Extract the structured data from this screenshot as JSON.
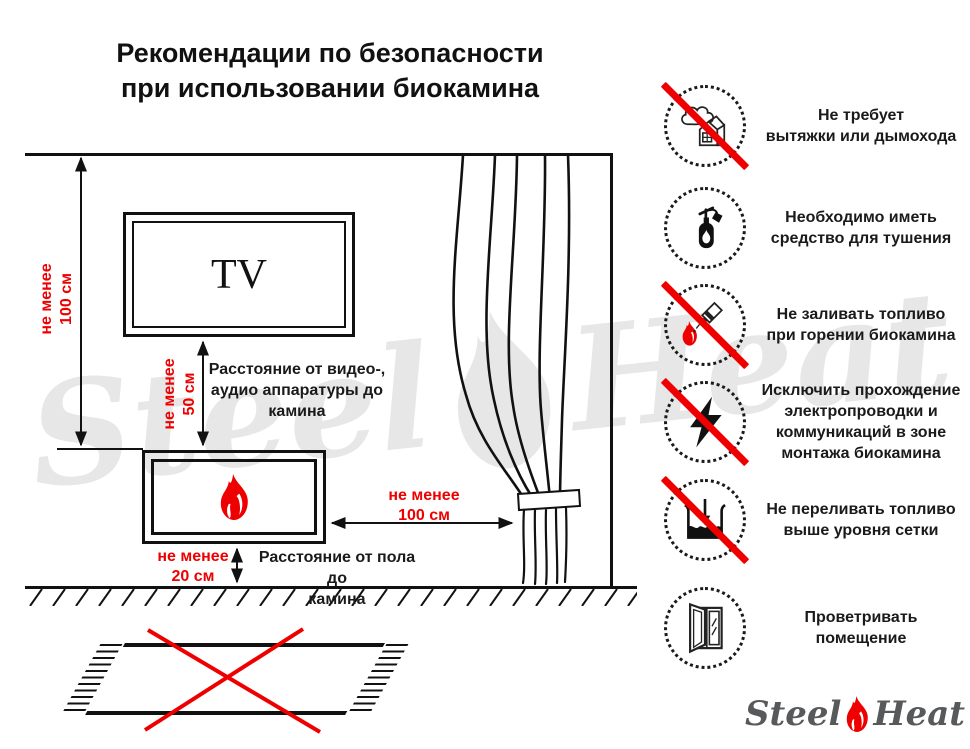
{
  "title": "Рекомендации по безопасности\nпри использовании биокамина",
  "diagram": {
    "tv_label": "TV",
    "dims": {
      "ceiling": "не менее\n100 см",
      "tv": "не менее\n50 см",
      "curtain": "не менее\n100 см",
      "floor": "не менее\n20 см"
    },
    "captions": {
      "tv": "Расстояние от видео-,\nаудио аппаратуры до\nкамина",
      "floor": "Расстояние от пола до\nкамина"
    }
  },
  "rules": [
    {
      "icon": "no-chimney-icon",
      "crossed": true,
      "text": "Не требует\nвытяжки или дымохода"
    },
    {
      "icon": "extinguisher-icon",
      "crossed": false,
      "text": "Необходимо иметь\nсредство для тушения"
    },
    {
      "icon": "no-refuel-icon",
      "crossed": true,
      "text": "Не заливать топливо\nпри горении биокамина"
    },
    {
      "icon": "no-wiring-icon",
      "crossed": true,
      "text": "Исключить прохождение\nэлектропроводки и\nкоммуникаций в зоне\nмонтажа биокамина"
    },
    {
      "icon": "no-overfill-icon",
      "crossed": true,
      "text": "Не переливать топливо\nвыше уровня сетки"
    },
    {
      "icon": "ventilate-icon",
      "crossed": false,
      "text": "Проветривать\nпомещение"
    }
  ],
  "watermark": {
    "steel": "Steel",
    "heat": "Heat"
  },
  "logo": {
    "steel": "Steel",
    "heat": "Heat"
  },
  "colors": {
    "red": "#ee0000",
    "line_black": "#111111",
    "logo_gray": "#58595b",
    "watermark_gray": "#e7e7e7"
  }
}
